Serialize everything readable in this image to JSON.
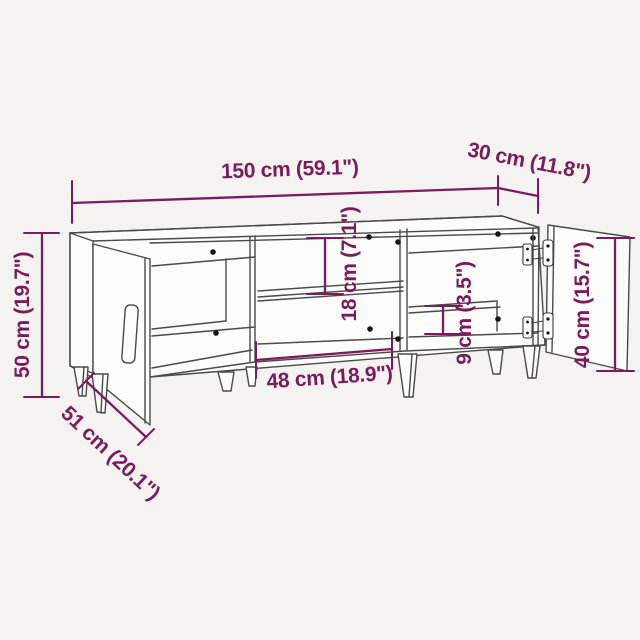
{
  "diagram": {
    "subject": "tv-cabinet-dimension-diagram",
    "colors": {
      "background": "#f4f3f1",
      "line_color": "#4a4a4a",
      "annotation_color": "#7b1b5c"
    },
    "dimensions": {
      "width_top": {
        "label": "150 cm (59.1\")"
      },
      "depth_top": {
        "label": "30 cm (11.8\")"
      },
      "height_left": {
        "label": "50 cm (19.7\")"
      },
      "depth_bottom_left": {
        "label": "51 cm (20.1\")"
      },
      "middle_opening_width": {
        "label": "48 cm (18.9\")"
      },
      "middle_opening_height": {
        "label": "18 cm (7.1\")"
      },
      "right_opening_height": {
        "label": "9 cm (3.5\")"
      },
      "right_door_height": {
        "label": "40 cm (15.7\")"
      }
    }
  }
}
